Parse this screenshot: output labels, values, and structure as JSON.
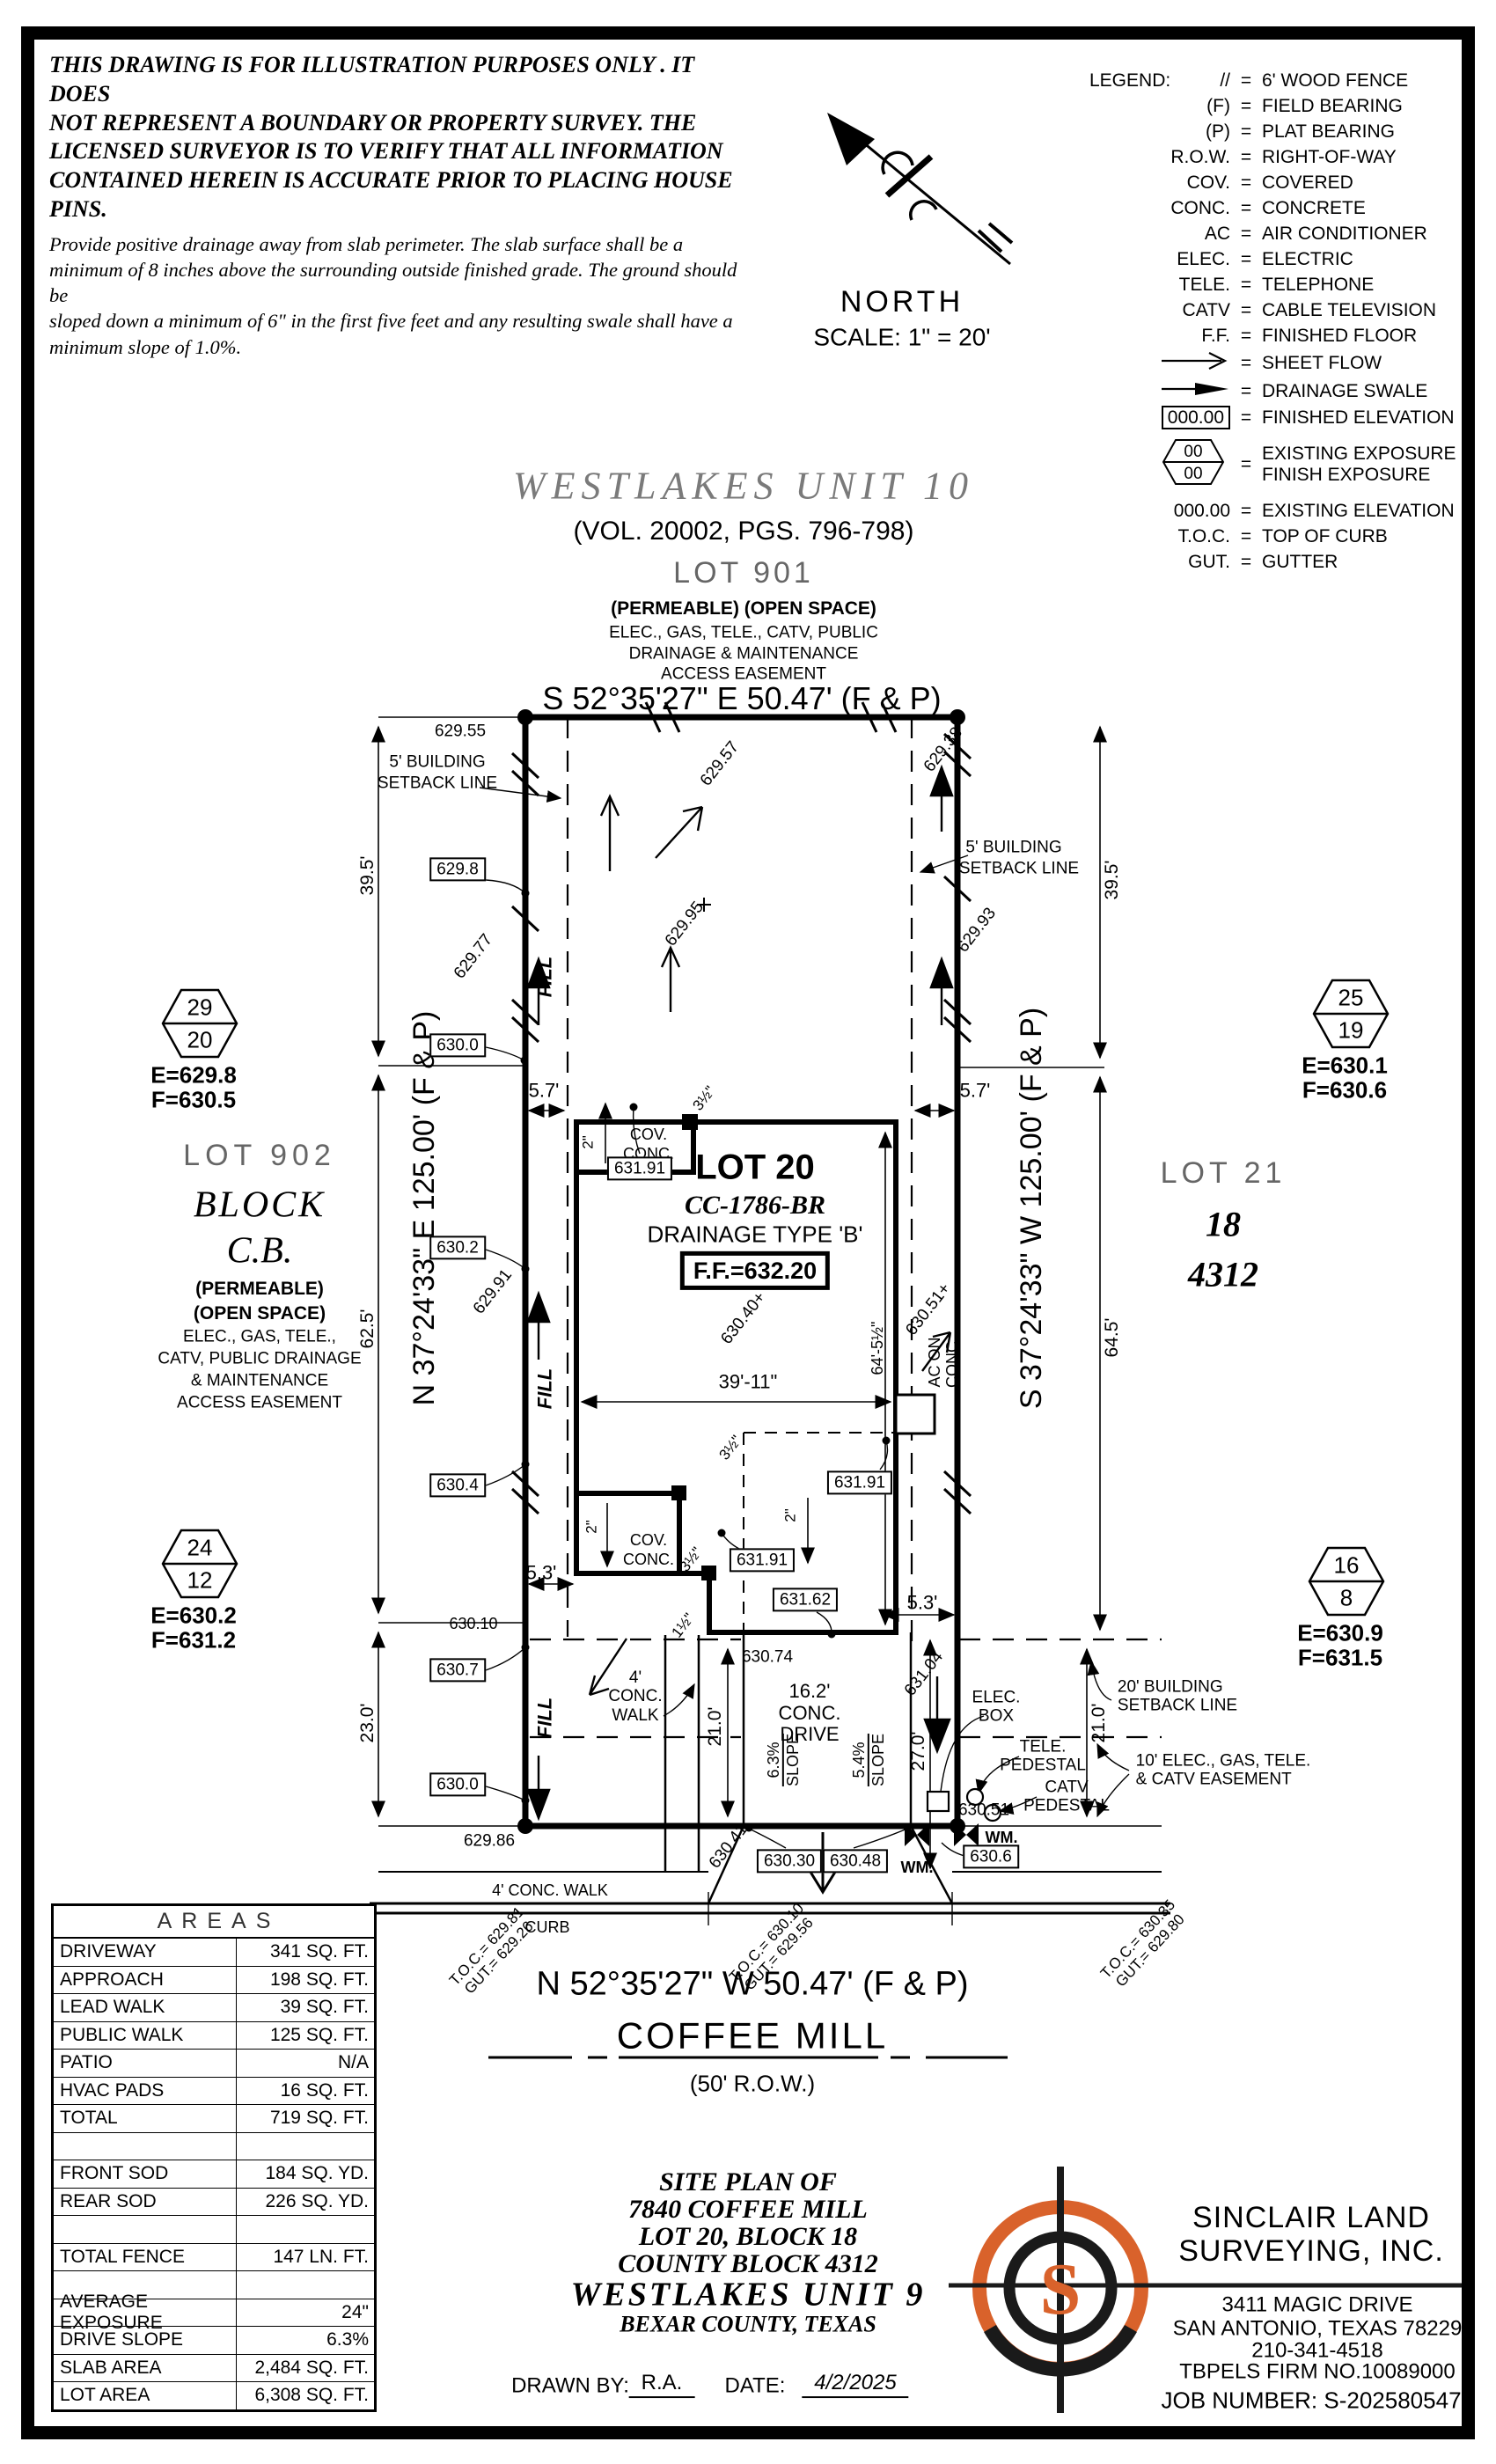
{
  "disclaimer": {
    "l1": "THIS DRAWING IS FOR ILLUSTRATION PURPOSES ONLY . IT DOES",
    "l2": "NOT REPRESENT A BOUNDARY OR PROPERTY SURVEY. THE",
    "l3": "LICENSED SURVEYOR IS TO VERIFY THAT ALL INFORMATION",
    "l4": "CONTAINED HEREIN IS ACCURATE PRIOR TO PLACING HOUSE PINS.",
    "l5": "Provide positive drainage away from slab perimeter. The slab surface shall be a",
    "l6": "minimum of 8 inches above the surrounding outside finished grade. The ground should be",
    "l7": "sloped down a minimum of 6\" in the first five feet and any resulting swale shall have a",
    "l8": "minimum slope of 1.0%."
  },
  "north_arrow": {
    "label": "NORTH",
    "scale": "SCALE:  1\" = 20'"
  },
  "legend": {
    "title": "LEGEND:",
    "rows": [
      {
        "s": "//",
        "d": "6' WOOD FENCE"
      },
      {
        "s": "(F)",
        "d": "FIELD BEARING"
      },
      {
        "s": "(P)",
        "d": "PLAT BEARING"
      },
      {
        "s": "R.O.W.",
        "d": "RIGHT-OF-WAY"
      },
      {
        "s": "COV.",
        "d": "COVERED"
      },
      {
        "s": "CONC.",
        "d": "CONCRETE"
      },
      {
        "s": "AC",
        "d": "AIR CONDITIONER"
      },
      {
        "s": "ELEC.",
        "d": "ELECTRIC"
      },
      {
        "s": "TELE.",
        "d": "TELEPHONE"
      },
      {
        "s": "CATV",
        "d": "CABLE TELEVISION"
      },
      {
        "s": "F.F.",
        "d": "FINISHED FLOOR"
      }
    ],
    "sheet_flow": "SHEET FLOW",
    "swale": "DRAINAGE SWALE",
    "fin_elev_sym": "000.00",
    "fin_elev": "FINISHED ELEVATION",
    "hex_top": "00",
    "hex_bot": "00",
    "exp1": "EXISTING EXPOSURE",
    "exp2": "FINISH EXPOSURE",
    "ex_elev_sym": "000.00",
    "ex_elev": "EXISTING ELEVATION",
    "toc": "T.O.C.",
    "toc_d": "TOP OF CURB",
    "gut": "GUT.",
    "gut_d": "GUTTER"
  },
  "header": {
    "h1": "WESTLAKES UNIT 10",
    "h2": "(VOL. 20002, PGS. 796-798)",
    "h3": "LOT 901",
    "h4": "(PERMEABLE) (OPEN SPACE)",
    "h5": "ELEC., GAS, TELE., CATV, PUBLIC",
    "h6": "DRAINAGE & MAINTENANCE",
    "h7": "ACCESS EASEMENT",
    "nb": "S 52°35'27\" E 50.47' (F & P)"
  },
  "hex": {
    "h29": [
      "29",
      "20",
      "E=629.8",
      "F=630.5"
    ],
    "h25": [
      "25",
      "19",
      "E=630.1",
      "F=630.6"
    ],
    "h24": [
      "24",
      "12",
      "E=630.2",
      "F=631.2"
    ],
    "h16": [
      "16",
      "8",
      "E=630.9",
      "F=631.5"
    ]
  },
  "L": {
    "e62955": "629.55",
    "e62957": "629.57",
    "e62938": "629.38",
    "e62977": "629.77",
    "e62991": "629.91",
    "e62993": "629.93",
    "e62995": "629.95",
    "e62986": "629.86",
    "b6298": "629.8",
    "b6300": "630.0",
    "b6302": "630.2",
    "b6304": "630.4",
    "b6307": "630.7",
    "t63010": "630.10",
    "sb5a": "5' BUILDING",
    "sb5b": "SETBACK LINE",
    "fill": "FILL",
    "d57": "5.7'",
    "d53": "5.3'",
    "d395": "39.5'",
    "d625": "62.5'",
    "d645": "64.5'",
    "d230": "23.0'",
    "d210": "21.0'",
    "d270": "27.0'",
    "cov": "COV.",
    "conc": "CONC.",
    "lot20": "LOT 20",
    "cc": "CC-1786-BR",
    "dr": "DRAINAGE TYPE 'B'",
    "ff": "F.F.=632.20",
    "e63040": "630.40+",
    "e63051p": "630.51+",
    "ac1": "AC ON",
    "ac2": "CONC.",
    "d64": "64'-5½\"",
    "d3911": "39'-11\"",
    "d35": "3½\"",
    "d2": "2\"",
    "d15": "1½\"",
    "b63191": "631.91",
    "b63162": "631.62",
    "e63074": "630.74",
    "e63104": "631.04",
    "e63041": "630.41",
    "e63051": "630.51",
    "w4": "4'",
    "walk": "WALK",
    "d162": "16.2'",
    "drive": "DRIVE",
    "s63": "6.3%",
    "s54": "5.4%",
    "slope": "SLOPE",
    "elec": "ELEC.",
    "box": "BOX",
    "tele": "TELE.",
    "ped": "PEDESTAL",
    "catv": "CATV",
    "bs20a": "20' BUILDING",
    "es10a": "10' ELEC., GAS, TELE.",
    "es10b": "& CATV EASEMENT",
    "wm": "WM.",
    "b63030": "630.30",
    "b63048": "630.48",
    "b6306": "630.6",
    "toc1a": "T.O.C.= 629.81",
    "toc1b": "GUT.= 629.26",
    "toc2a": "T.O.C.= 630.10",
    "toc2b": "GUT.= 629.56",
    "toc3a": "T.O.C.= 630.35",
    "toc3b": "GUT.= 629.80",
    "cwalk": "4' CONC. WALK",
    "curb": "CURB",
    "stb": "N 52°35'27\" W 50.47' (F & P)",
    "stname": "COFFEE MILL",
    "row": "(50' R.O.W.)",
    "wb": "N 37°24'33\" E 125.00' (F & P)",
    "eb": "S 37°24'33\" W 125.00' (F & P)",
    "lot902": "LOT 902",
    "blk": "BLOCK",
    "cb": "C.B.",
    "perm": "(PERMEABLE)",
    "open": "(OPEN SPACE)",
    "ez1": "ELEC., GAS, TELE.,",
    "ez2": "CATV, PUBLIC DRAINAGE",
    "ez3": "& MAINTENANCE",
    "ez4": "ACCESS EASEMENT",
    "lot21": "LOT 21",
    "n18": "18",
    "n4312": "4312"
  },
  "areas": {
    "title": "AREAS",
    "rows": [
      [
        "DRIVEWAY",
        "341 SQ. FT."
      ],
      [
        "APPROACH",
        "198 SQ. FT."
      ],
      [
        "LEAD WALK",
        "39 SQ. FT."
      ],
      [
        "PUBLIC WALK",
        "125 SQ. FT."
      ],
      [
        "PATIO",
        "N/A"
      ],
      [
        "HVAC PADS",
        "16 SQ. FT."
      ],
      [
        "TOTAL",
        "719 SQ. FT."
      ],
      [
        "",
        ""
      ],
      [
        "FRONT SOD",
        "184 SQ. YD."
      ],
      [
        "REAR SOD",
        "226 SQ. YD."
      ],
      [
        "",
        ""
      ],
      [
        "TOTAL FENCE",
        "147 LN. FT."
      ],
      [
        "",
        ""
      ],
      [
        "AVERAGE EXPOSURE",
        "24\""
      ],
      [
        "DRIVE SLOPE",
        "6.3%"
      ],
      [
        "SLAB AREA",
        "2,484 SQ. FT."
      ],
      [
        "LOT AREA",
        "6,308 SQ. FT."
      ]
    ]
  },
  "title_block": {
    "l1": "SITE PLAN OF",
    "l2": "7840 COFFEE MILL",
    "l3": "LOT 20, BLOCK 18",
    "l4": "COUNTY BLOCK 4312",
    "l5": "WESTLAKES UNIT 9",
    "l6": "BEXAR COUNTY, TEXAS",
    "drawn_label": "DRAWN BY:",
    "drawn": "R.A.",
    "date_label": "DATE:",
    "date": "4/2/2025"
  },
  "firm": {
    "n1": "SINCLAIR LAND",
    "n2": "SURVEYING, INC.",
    "a1": "3411 MAGIC DRIVE",
    "a2": "SAN ANTONIO, TEXAS 78229",
    "a3": "210-341-4518",
    "a4": "TBPELS FIRM NO.10089000",
    "job": "JOB NUMBER:  S-202580547",
    "logo_letter": "S",
    "logo_color": "#d9622b"
  }
}
